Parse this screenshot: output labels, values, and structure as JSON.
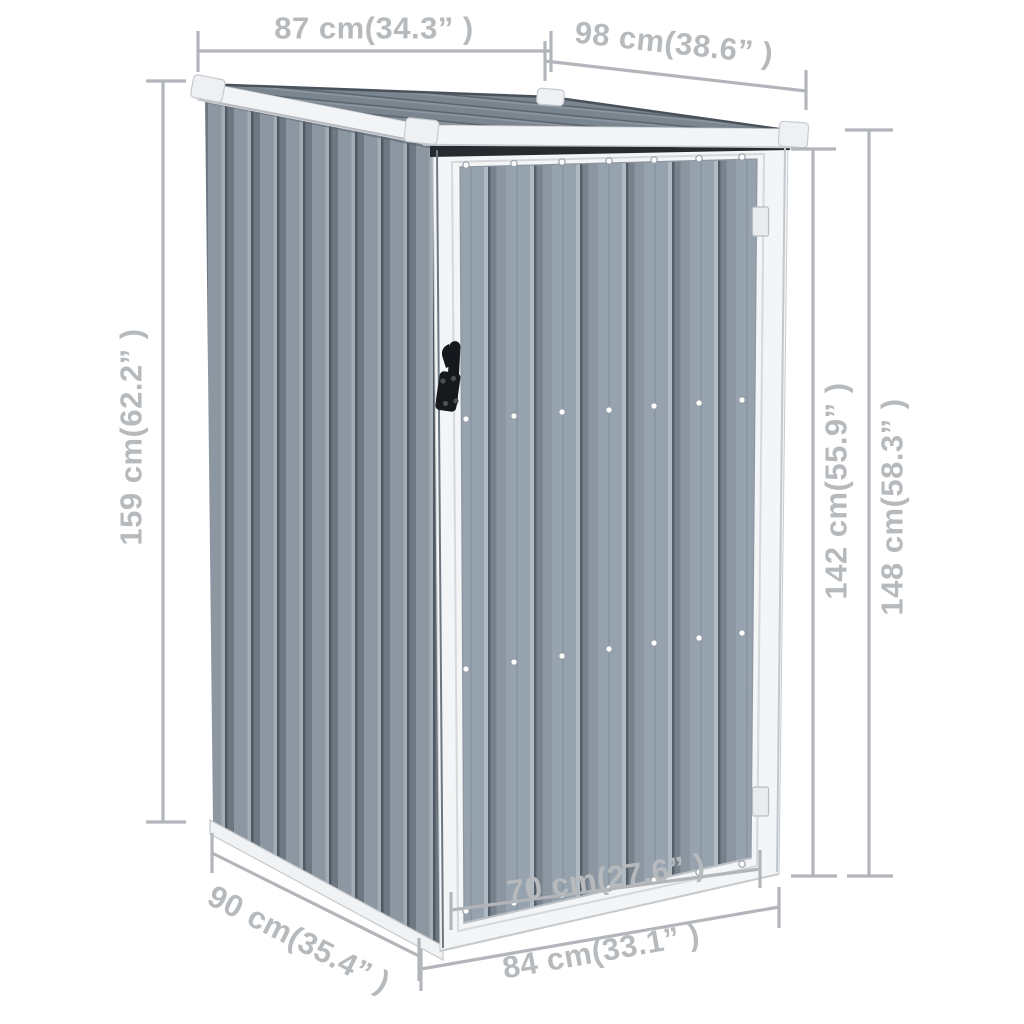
{
  "colors": {
    "background": "#ffffff",
    "dimension": "#b2b5b9",
    "dimension_text": "#b7babd",
    "wall_gray": "#8d97a2",
    "door_gray": "#96a2ad",
    "roof_gray": "#7a858f",
    "trim_white": "#f3f5f6",
    "base_white": "#f0f2f4",
    "shadow_dark": "#262b30",
    "handle_black": "#17191d"
  },
  "dims": {
    "d87": {
      "label": "87 cm(34.3” )",
      "cm": 87,
      "inch": 34.3
    },
    "d98": {
      "label": "98 cm(38.6” )",
      "cm": 98,
      "inch": 38.6
    },
    "d159": {
      "label": "159 cm(62.2” )",
      "cm": 159,
      "inch": 62.2
    },
    "d142": {
      "label": "142 cm(55.9” )",
      "cm": 142,
      "inch": 55.9
    },
    "d148": {
      "label": "148 cm(58.3” )",
      "cm": 148,
      "inch": 58.3
    },
    "d90": {
      "label": "90 cm(35.4” )",
      "cm": 90,
      "inch": 35.4
    },
    "d70": {
      "label": "70 cm(27.6” )",
      "cm": 70,
      "inch": 27.6
    },
    "d84": {
      "label": "84 cm(33.1” )",
      "cm": 84,
      "inch": 33.1
    }
  }
}
